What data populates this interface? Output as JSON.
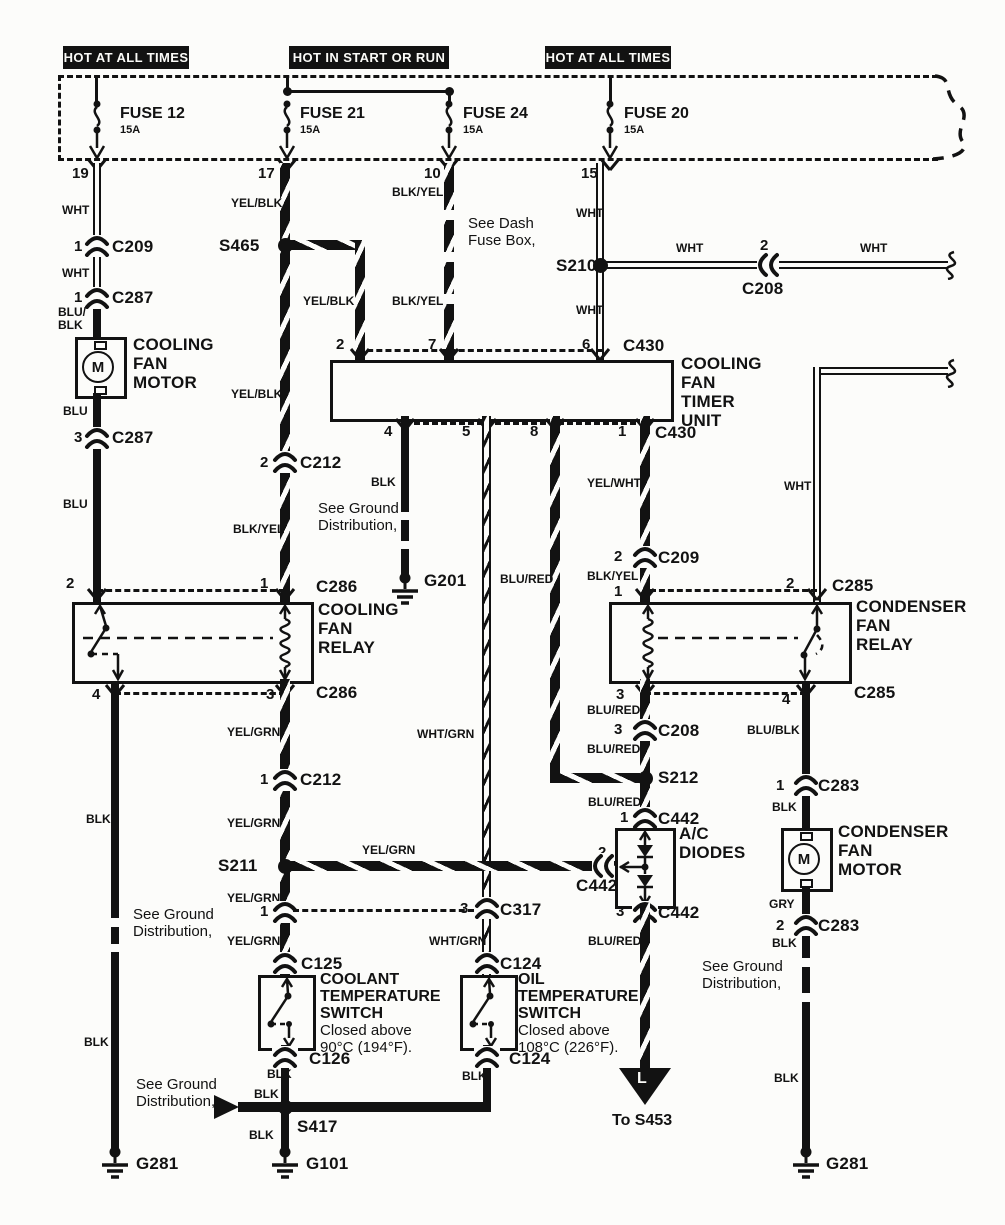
{
  "banner": {
    "left": "HOT AT ALL TIMES",
    "mid": "HOT IN START OR RUN",
    "right": "HOT AT ALL TIMES"
  },
  "fuse": {
    "f12": "FUSE 12",
    "f12a": "15A",
    "f12p": "19",
    "f21": "FUSE 21",
    "f21a": "15A",
    "f21p": "17",
    "f24": "FUSE 24",
    "f24a": "15A",
    "f24p": "10",
    "f20": "FUSE 20",
    "f20a": "15A",
    "f20p": "15"
  },
  "comp": {
    "cfm": "COOLING\nFAN\nMOTOR",
    "timer": "COOLING\nFAN\nTIMER\nUNIT",
    "cfr": "COOLING\nFAN\nRELAY",
    "cdr": "CONDENSER\nFAN\nRELAY",
    "cdm": "CONDENSER\nFAN\nMOTOR",
    "acd": "A/C\nDIODES",
    "cts": "COOLANT\nTEMPERATURE\nSWITCH",
    "cts_note": "Closed above\n90°C (194°F).",
    "ots": "OIL\nTEMPERATURE\nSWITCH",
    "ots_note": "Closed above\n108°C (226°F).",
    "m1": "M",
    "m2": "M"
  },
  "wire": {
    "wht1": "WHT",
    "wht2": "WHT",
    "blublk": "BLU/\nBLK",
    "blu1": "BLU",
    "blu2": "BLU",
    "yelblk1": "YEL/BLK",
    "yelblk2": "YEL/BLK",
    "yelblk3": "YEL/BLK",
    "blkyel1": "BLK/YEL",
    "blkyel_f24a": "BLK/YEL",
    "blkyel_f24b": "BLK/YEL",
    "wht_f20a": "WHT",
    "wht_f20b": "WHT",
    "wht_h1": "WHT",
    "wht_h2": "WHT",
    "wht_r": "WHT",
    "blk_g201": "BLK",
    "whtgrn1": "WHT/GRN",
    "whtgrn2": "WHT/GRN",
    "blured_p8": "BLU/RED",
    "yelwht": "YEL/WHT",
    "blkyel2": "BLK/YEL",
    "yelgrn1": "YEL/GRN",
    "yelgrn2": "YEL/GRN",
    "yelgrn3": "YEL/GRN",
    "yelgrn4": "YEL/GRN",
    "yelgrn5": "YEL/GRN",
    "blured1": "BLU/RED",
    "blured2": "BLU/RED",
    "blured3": "BLU/RED",
    "blured4": "BLU/RED",
    "blublk2": "BLU/BLK",
    "blk_r1": "BLK",
    "gry": "GRY",
    "blk_r2": "BLK",
    "blk_r3": "BLK",
    "blk_l1": "BLK",
    "blk_l2": "BLK",
    "blk_c126": "BLK",
    "blk_s417a": "BLK",
    "blk_s417b": "BLK",
    "blk_oil": "BLK"
  },
  "conn": {
    "c209_1p": "1",
    "c209_1": "C209",
    "c287_1p": "1",
    "c287_1": "C287",
    "c287_3p": "3",
    "c287_3": "C287",
    "c212_2p": "2",
    "c212_2": "C212",
    "c212_1p": "1",
    "c212_1": "C212",
    "c286_2p": "2",
    "c286_1p": "1",
    "c286_1": "C286",
    "c286_4p": "4",
    "c286_3p": "3",
    "c286_3": "C286",
    "c317_1p": "1",
    "c317_3p": "3",
    "c317_3": "C317",
    "c125": "C125",
    "c126": "C126",
    "c124_t": "C124",
    "c124_b": "C124",
    "t2": "2",
    "t7": "7",
    "t6": "6",
    "c430_t": "C430",
    "t4": "4",
    "t5": "5",
    "t8": "8",
    "t1": "1",
    "c430_b": "C430",
    "c209_2p": "2",
    "c209_2": "C209",
    "c285_1p": "1",
    "c285_2p": "2",
    "c285_t": "C285",
    "c285_3p": "3",
    "c285_4p": "4",
    "c285_b": "C285",
    "c208_2p": "2",
    "c208_2": "C208",
    "c208_3p": "3",
    "c208_3": "C208",
    "c442_1p": "1",
    "c442_1": "C442",
    "c442_2p": "2",
    "c442_2": "C442",
    "c442_3p": "3",
    "c442_3": "C442",
    "c283_1p": "1",
    "c283_1": "C283",
    "c283_2p": "2",
    "c283_2": "C283"
  },
  "splice": {
    "s465": "S465",
    "s210": "S210",
    "s211": "S211",
    "s212": "S212",
    "s417": "S417"
  },
  "ground": {
    "g201": "G201",
    "g101": "G101",
    "g281l": "G281",
    "g281r": "G281"
  },
  "note": {
    "dashbox": "See Dash\nFuse Box,",
    "gd1": "See Ground\nDistribution,",
    "gd2": "See Ground\nDistribution,",
    "gd3": "See Ground\nDistribution,",
    "gd4": "See Ground\nDistribution,",
    "tos453": "To S453",
    "tri": "L"
  }
}
